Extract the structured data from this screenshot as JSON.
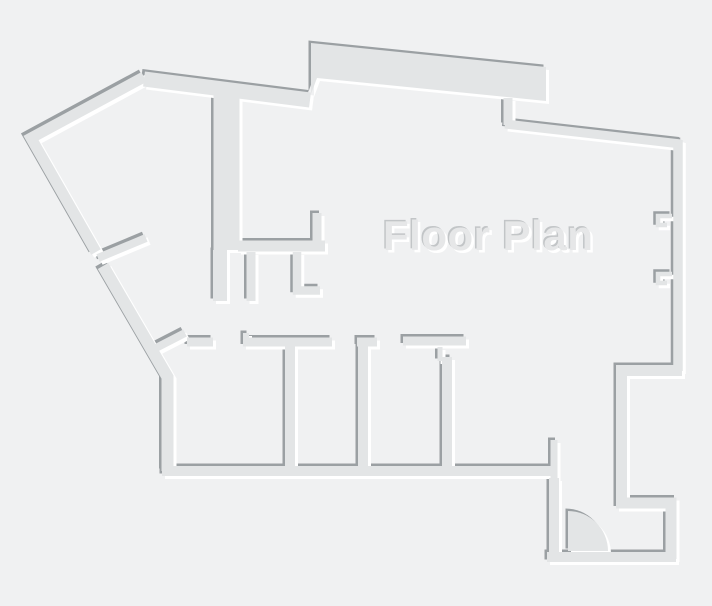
{
  "canvas": {
    "width": 712,
    "height": 606
  },
  "title": {
    "text": "Floor Plan"
  },
  "colors": {
    "background": "#f0f1f2",
    "wall_fill": "#e3e5e6",
    "wall_shadow": "#9ba0a3",
    "wall_highlight": "#ffffff",
    "title_fill": "#e6e7e8",
    "title_shadow_dark": "#c2c5c7",
    "title_shadow_light": "#ffffff"
  },
  "emboss": {
    "shadow_offset": 2.5,
    "highlight_offset": 3
  },
  "floor_plan": {
    "stroked_walls": [
      {
        "name": "exterior-wall-upper-left-slant",
        "points": [
          [
            144,
            77
          ],
          [
            31,
            138
          ],
          [
            96,
            252
          ]
        ],
        "width": 11
      },
      {
        "name": "exterior-wall-lower-left-slant",
        "points": [
          [
            103,
            266
          ],
          [
            167.5,
            377
          ],
          [
            167.5,
            471
          ]
        ],
        "width": 12
      },
      {
        "name": "exterior-wall-top",
        "points": [
          [
            144,
            79
          ],
          [
            310,
            100
          ]
        ],
        "width": 15
      },
      {
        "name": "top-step-connector",
        "points": [
          [
            508,
            98
          ],
          [
            508,
            125
          ]
        ],
        "width": 9
      },
      {
        "name": "exterior-wall-top-right",
        "points": [
          [
            505,
            124
          ],
          [
            681,
            144
          ]
        ],
        "width": 9
      },
      {
        "name": "exterior-wall-right",
        "points": [
          [
            678,
            140
          ],
          [
            678,
            371
          ]
        ],
        "width": 9.5
      },
      {
        "name": "window-bracket-upper",
        "points": [
          [
            672,
            216
          ],
          [
            658,
            216
          ],
          [
            658,
            225
          ],
          [
            667,
            225
          ]
        ],
        "width": 4.5
      },
      {
        "name": "window-bracket-lower",
        "points": [
          [
            672,
            274
          ],
          [
            658,
            274
          ],
          [
            658,
            283
          ],
          [
            667,
            283
          ]
        ],
        "width": 4.5
      },
      {
        "name": "exterior-wall-right-step",
        "points": [
          [
            682,
            370.5
          ],
          [
            621.5,
            370.5
          ],
          [
            621.5,
            503
          ],
          [
            671,
            503
          ],
          [
            671,
            559
          ]
        ],
        "width": 11
      },
      {
        "name": "entry-bottom-wall",
        "points": [
          [
            547,
            557
          ],
          [
            676,
            557
          ]
        ],
        "width": 10
      },
      {
        "name": "entry-left-wall",
        "points": [
          [
            554,
            478
          ],
          [
            554,
            560
          ]
        ],
        "width": 10
      },
      {
        "name": "entry-left-stub",
        "points": [
          [
            554,
            440
          ],
          [
            554,
            478
          ]
        ],
        "width": 7
      },
      {
        "name": "rooms-bottom-wall",
        "points": [
          [
            162,
            471
          ],
          [
            551,
            471
          ]
        ],
        "width": 10
      },
      {
        "name": "rooms-top-wall-diagonal",
        "points": [
          [
            152,
            350
          ],
          [
            185,
            333
          ]
        ],
        "width": 8
      },
      {
        "name": "rooms-top-wall-segment-1",
        "points": [
          [
            187,
            342
          ],
          [
            213,
            342
          ]
        ],
        "width": 9
      },
      {
        "name": "rooms-top-wall-segment-2",
        "points": [
          [
            243,
            342
          ],
          [
            332,
            342
          ]
        ],
        "width": 9
      },
      {
        "name": "rooms-top-wall-jog",
        "points": [
          [
            246,
            342
          ],
          [
            246,
            333
          ]
        ],
        "width": 6
      },
      {
        "name": "room-divider-a",
        "points": [
          [
            290,
            346
          ],
          [
            290,
            466
          ]
        ],
        "width": 10
      },
      {
        "name": "rooms-top-wall-segment-3",
        "points": [
          [
            357,
            342
          ],
          [
            377,
            342
          ]
        ],
        "width": 9
      },
      {
        "name": "room-divider-b",
        "points": [
          [
            363,
            346
          ],
          [
            363,
            466
          ]
        ],
        "width": 10
      },
      {
        "name": "rooms-top-wall-segment-4",
        "points": [
          [
            403,
            341
          ],
          [
            466,
            341
          ]
        ],
        "width": 9
      },
      {
        "name": "room-divider-c-tick",
        "points": [
          [
            440,
            347
          ],
          [
            440,
            361
          ]
        ],
        "width": 5
      },
      {
        "name": "room-divider-c",
        "points": [
          [
            447,
            357
          ],
          [
            447,
            466
          ]
        ],
        "width": 10
      },
      {
        "name": "hall-wall-thick",
        "points": [
          [
            226.5,
            84
          ],
          [
            226.5,
            250
          ]
        ],
        "width": 26
      },
      {
        "name": "hall-wall-thin",
        "points": [
          [
            220,
            250
          ],
          [
            220,
            301
          ]
        ],
        "width": 14
      },
      {
        "name": "interior-wall-horizontal",
        "points": [
          [
            238,
            246
          ],
          [
            325,
            246
          ]
        ],
        "width": 11
      },
      {
        "name": "interior-stub-up",
        "points": [
          [
            317,
            213
          ],
          [
            317,
            246
          ]
        ],
        "width": 9
      },
      {
        "name": "interior-stub-down-left",
        "points": [
          [
            251,
            252
          ],
          [
            251,
            301
          ]
        ],
        "width": 9
      },
      {
        "name": "interior-stub-down-right",
        "points": [
          [
            297,
            252
          ],
          [
            297,
            290.5
          ],
          [
            320,
            290.5
          ]
        ],
        "width": 8.5
      },
      {
        "name": "door-jamb-stub-left",
        "points": [
          [
            98,
            258
          ],
          [
            146,
            238
          ]
        ],
        "width": 8
      }
    ],
    "filled_shapes": [
      {
        "name": "thick-top-wall-bump",
        "path": "M 311,43 L 546,67 L 546,101 L 317,78 L 311,94 Z"
      },
      {
        "name": "entry-door-swing",
        "path": "M 568,551 L 568,511 A 40 40 0 0 1 608,551 Z"
      }
    ]
  }
}
